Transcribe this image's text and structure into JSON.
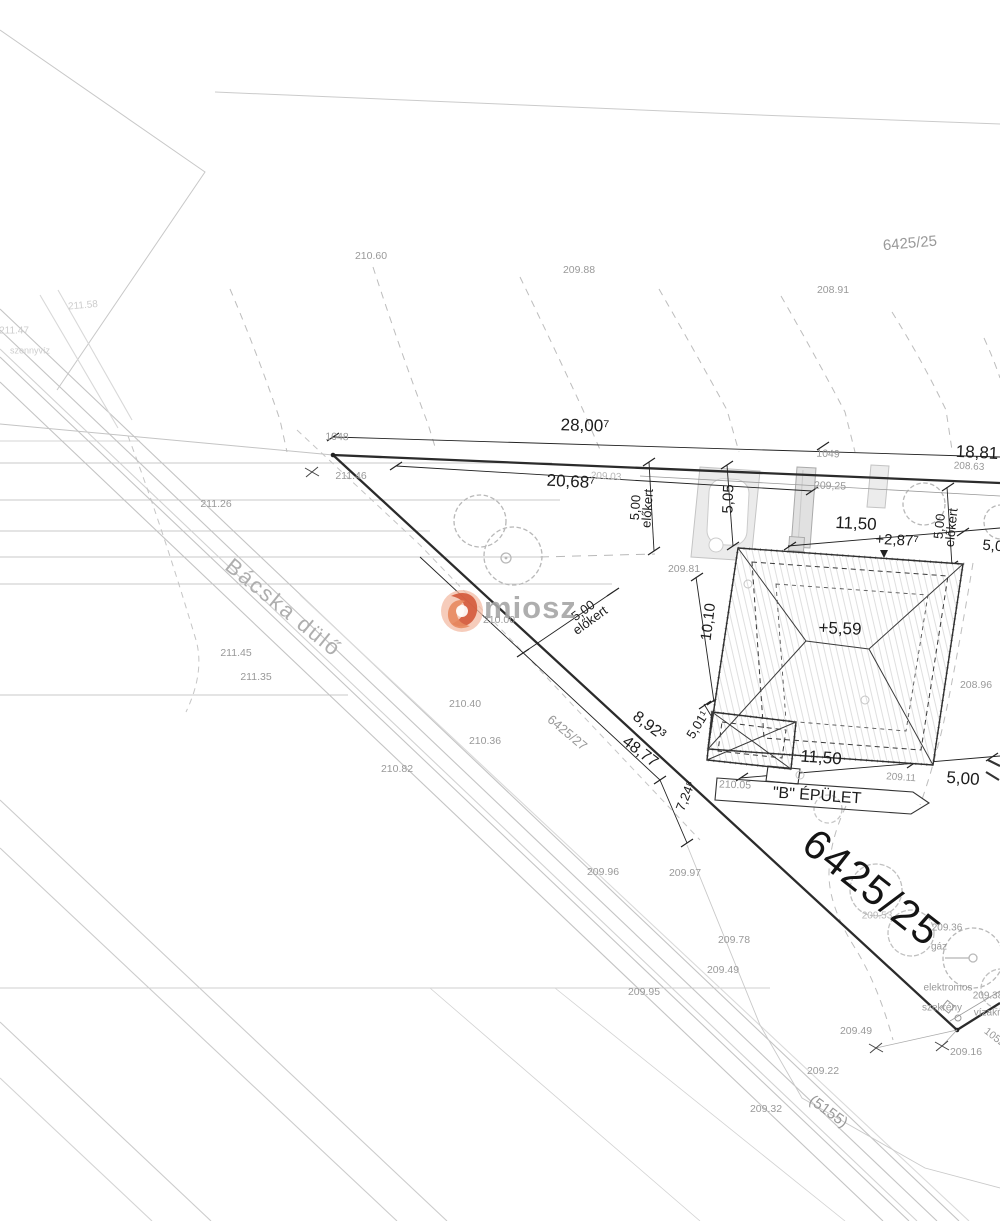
{
  "plan": {
    "type": "helyszínrajz (site plan)",
    "main_parcel": "6425/25",
    "road_parcel": "(5155)",
    "adjacent_parcel": "6425/27",
    "street_name": "Bácska dülő",
    "building_label": "\"B\" ÉPÜLET",
    "survey_point_numbers": [
      "1048",
      "1049",
      "1052"
    ]
  },
  "watermark": {
    "text": "miosz",
    "logo": "miosz-swirl-icon",
    "accent_color": "#cc4b2e"
  },
  "colors": {
    "boundary": "#2b2b2b",
    "dimension_text": "#1c1c1c",
    "elevation_text": "#999999",
    "contour": "#bdbdbd",
    "road": "#c4c4c4",
    "paving_fill": "#ebebeb"
  },
  "labels": [
    {
      "id": "parcel-6425-25-top",
      "text": "6425/25",
      "x": 910,
      "y": 244,
      "rot": -5,
      "fs": 15,
      "kind": "elev"
    },
    {
      "id": "spot-210-60",
      "text": "210.60",
      "x": 371,
      "y": 257,
      "rot": 0,
      "fs": 10.5,
      "kind": "elev"
    },
    {
      "id": "spot-209-88",
      "text": "209.88",
      "x": 579,
      "y": 271,
      "rot": 0,
      "fs": 10.5,
      "kind": "elev"
    },
    {
      "id": "spot-208-91",
      "text": "208.91",
      "x": 833,
      "y": 291,
      "rot": 0,
      "fs": 10.5,
      "kind": "elev"
    },
    {
      "id": "spot-211-58",
      "text": "211.58",
      "x": 83,
      "y": 306,
      "rot": -5,
      "fs": 10,
      "kind": "faint"
    },
    {
      "id": "spot-211-47",
      "text": "211.47",
      "x": 14,
      "y": 331,
      "rot": 0,
      "fs": 10,
      "kind": "faint"
    },
    {
      "id": "note-szennyviz",
      "text": "szennyvíz",
      "x": 30,
      "y": 351,
      "rot": 0,
      "fs": 9,
      "kind": "faint"
    },
    {
      "id": "dim-28-00",
      "text": "28,00⁷",
      "x": 585,
      "y": 426,
      "rot": 1.5,
      "fs": 17,
      "kind": "dim"
    },
    {
      "id": "pt-1048",
      "text": "1048",
      "x": 337,
      "y": 438,
      "rot": 1,
      "fs": 10.5,
      "kind": "elev"
    },
    {
      "id": "dim-18-81",
      "text": "18,81",
      "x": 977,
      "y": 453,
      "rot": 3,
      "fs": 17,
      "kind": "dim"
    },
    {
      "id": "spot-208-63",
      "text": "208.63",
      "x": 969,
      "y": 467,
      "rot": 3,
      "fs": 10,
      "kind": "elev"
    },
    {
      "id": "pt-1049",
      "text": "1049",
      "x": 828,
      "y": 455,
      "rot": 2,
      "fs": 10.5,
      "kind": "elev"
    },
    {
      "id": "spot-211-46",
      "text": "211.46",
      "x": 351,
      "y": 477,
      "rot": 0,
      "fs": 10.5,
      "kind": "elev"
    },
    {
      "id": "dim-20-68",
      "text": "20,68⁷",
      "x": 571,
      "y": 482,
      "rot": 3,
      "fs": 17,
      "kind": "dim"
    },
    {
      "id": "spot-209-03",
      "text": "209.03",
      "x": 606,
      "y": 477,
      "rot": 3,
      "fs": 10,
      "kind": "faint2"
    },
    {
      "id": "spot-209-25",
      "text": "209,25",
      "x": 830,
      "y": 487,
      "rot": 2,
      "fs": 10.5,
      "kind": "elev"
    },
    {
      "id": "spot-211-26",
      "text": "211.26",
      "x": 216,
      "y": 505,
      "rot": 0,
      "fs": 10.5,
      "kind": "elev"
    },
    {
      "id": "dim-5-05",
      "text": "5,05",
      "x": 729,
      "y": 499,
      "rot": -88,
      "fs": 15,
      "kind": "dim"
    },
    {
      "id": "dim-11-50-top",
      "text": "11,50",
      "x": 856,
      "y": 524,
      "rot": 3,
      "fs": 17,
      "kind": "dim"
    },
    {
      "id": "dim-plus-2-87",
      "text": "+2,87⁷",
      "x": 897,
      "y": 541,
      "rot": 3,
      "fs": 15,
      "kind": "dim"
    },
    {
      "id": "dim-elokert-right",
      "text": "5,00\nelőkert",
      "x": 946,
      "y": 527,
      "rot": -84,
      "fs": 13,
      "kind": "dim2"
    },
    {
      "id": "dim-5-05-edge",
      "text": "5,05",
      "x": 997,
      "y": 547,
      "rot": 5,
      "fs": 15,
      "kind": "dim"
    },
    {
      "id": "spot-209-81",
      "text": "209.81",
      "x": 684,
      "y": 570,
      "rot": 0,
      "fs": 10.5,
      "kind": "elev"
    },
    {
      "id": "street-bacska-dulo",
      "text": "Bácska dülő",
      "x": 283,
      "y": 608,
      "rot": 39,
      "fs": 22,
      "kind": "street"
    },
    {
      "id": "spot-210-00",
      "text": "210.00",
      "x": 499,
      "y": 621,
      "rot": 0,
      "fs": 10.5,
      "kind": "elev"
    },
    {
      "id": "dim-elokert-left",
      "text": "5,00\nelőkert",
      "x": 587,
      "y": 616,
      "rot": -36,
      "fs": 13,
      "kind": "dim2"
    },
    {
      "id": "dim-elokert-mid",
      "text": "5,00\nelőkert",
      "x": 642,
      "y": 508,
      "rot": -86,
      "fs": 13,
      "kind": "dim2"
    },
    {
      "id": "dim-10-10",
      "text": "10,10",
      "x": 709,
      "y": 622,
      "rot": -83,
      "fs": 15,
      "kind": "dim"
    },
    {
      "id": "dim-plus-5-59",
      "text": "+5,59",
      "x": 840,
      "y": 629,
      "rot": 2,
      "fs": 17,
      "kind": "dim"
    },
    {
      "id": "spot-211-45",
      "text": "211.45",
      "x": 236,
      "y": 654,
      "rot": 0,
      "fs": 10.5,
      "kind": "elev"
    },
    {
      "id": "spot-211-35",
      "text": "211.35",
      "x": 256,
      "y": 678,
      "rot": 0,
      "fs": 10.5,
      "kind": "elev"
    },
    {
      "id": "spot-208-96",
      "text": "208.96",
      "x": 976,
      "y": 686,
      "rot": 0,
      "fs": 10.5,
      "kind": "elev"
    },
    {
      "id": "spot-210-40",
      "text": "210.40",
      "x": 465,
      "y": 705,
      "rot": 0,
      "fs": 10.5,
      "kind": "elev"
    },
    {
      "id": "dim-5-01",
      "text": "5,01¹",
      "x": 698,
      "y": 725,
      "rot": -58,
      "fs": 13,
      "kind": "dim"
    },
    {
      "id": "parcel-6425-27",
      "text": "6425/27",
      "x": 567,
      "y": 733,
      "rot": 40,
      "fs": 13,
      "kind": "elev"
    },
    {
      "id": "dim-8-92",
      "text": "8,92³",
      "x": 649,
      "y": 726,
      "rot": 37,
      "fs": 16,
      "kind": "dim"
    },
    {
      "id": "spot-210-36",
      "text": "210.36",
      "x": 485,
      "y": 742,
      "rot": 0,
      "fs": 10.5,
      "kind": "elev"
    },
    {
      "id": "dim-48-77",
      "text": "48,77",
      "x": 640,
      "y": 752,
      "rot": 37,
      "fs": 16,
      "kind": "dim"
    },
    {
      "id": "dim-7-24",
      "text": "7,24⁸",
      "x": 686,
      "y": 796,
      "rot": -68,
      "fs": 13,
      "kind": "dim"
    },
    {
      "id": "spot-210-82",
      "text": "210.82",
      "x": 397,
      "y": 770,
      "rot": 0,
      "fs": 10.5,
      "kind": "elev"
    },
    {
      "id": "dim-11-50-bottom",
      "text": "11,50",
      "x": 821,
      "y": 758,
      "rot": 4,
      "fs": 17,
      "kind": "dim"
    },
    {
      "id": "spot-209-11",
      "text": "209.11",
      "x": 901,
      "y": 778,
      "rot": 4,
      "fs": 10,
      "kind": "elev"
    },
    {
      "id": "dim-5-00-bottom",
      "text": "5,00",
      "x": 963,
      "y": 779,
      "rot": 4,
      "fs": 17,
      "kind": "dim"
    },
    {
      "id": "spot-210-05",
      "text": "210.05",
      "x": 735,
      "y": 786,
      "rot": 2,
      "fs": 10.5,
      "kind": "elev"
    },
    {
      "id": "label-b-epulet",
      "text": "\"B\" ÉPÜLET",
      "x": 817,
      "y": 796,
      "rot": 4,
      "fs": 16,
      "kind": "dim"
    },
    {
      "id": "parcel-6425-25-big",
      "text": "6425/25",
      "x": 872,
      "y": 888,
      "rot": 38,
      "fs": 41,
      "kind": "big"
    },
    {
      "id": "spot-209-96",
      "text": "209.96",
      "x": 603,
      "y": 873,
      "rot": 0,
      "fs": 10.5,
      "kind": "elev"
    },
    {
      "id": "spot-209-97",
      "text": "209.97",
      "x": 685,
      "y": 874,
      "rot": 0,
      "fs": 10.5,
      "kind": "elev"
    },
    {
      "id": "spot-209-53",
      "text": "209.53",
      "x": 877,
      "y": 916,
      "rot": 0,
      "fs": 10,
      "kind": "faint2"
    },
    {
      "id": "spot-209-36",
      "text": "209.36",
      "x": 947,
      "y": 928,
      "rot": 0,
      "fs": 10,
      "kind": "elev"
    },
    {
      "id": "util-gaz",
      "text": "gáz",
      "x": 939,
      "y": 947,
      "rot": 0,
      "fs": 10,
      "kind": "elev"
    },
    {
      "id": "spot-209-78",
      "text": "209.78",
      "x": 734,
      "y": 941,
      "rot": 0,
      "fs": 10.5,
      "kind": "elev"
    },
    {
      "id": "spot-209-49-a",
      "text": "209.49",
      "x": 723,
      "y": 971,
      "rot": 0,
      "fs": 10.5,
      "kind": "elev"
    },
    {
      "id": "util-elektromos",
      "text": "elektromos",
      "x": 948,
      "y": 988,
      "rot": 0,
      "fs": 10,
      "kind": "elev"
    },
    {
      "id": "spot-209-38",
      "text": "209.38",
      "x": 988,
      "y": 996,
      "rot": 0,
      "fs": 10,
      "kind": "elev"
    },
    {
      "id": "util-szekreny",
      "text": "szekrény",
      "x": 942,
      "y": 1008,
      "rot": 0,
      "fs": 10,
      "kind": "elev"
    },
    {
      "id": "util-vizakna",
      "text": "vízakna",
      "x": 991,
      "y": 1013,
      "rot": 0,
      "fs": 10,
      "kind": "elev"
    },
    {
      "id": "spot-209-95",
      "text": "209.95",
      "x": 644,
      "y": 993,
      "rot": 0,
      "fs": 10.5,
      "kind": "elev"
    },
    {
      "id": "spot-209-49-b",
      "text": "209.49",
      "x": 856,
      "y": 1032,
      "rot": 0,
      "fs": 10.5,
      "kind": "elev"
    },
    {
      "id": "pt-1052",
      "text": "1052",
      "x": 994,
      "y": 1038,
      "rot": 38,
      "fs": 10.5,
      "kind": "elev"
    },
    {
      "id": "spot-209-16",
      "text": "209.16",
      "x": 966,
      "y": 1053,
      "rot": 0,
      "fs": 10.5,
      "kind": "elev"
    },
    {
      "id": "spot-209-22",
      "text": "209.22",
      "x": 823,
      "y": 1072,
      "rot": 0,
      "fs": 10.5,
      "kind": "elev"
    },
    {
      "id": "road-5155",
      "text": "(5155)",
      "x": 828,
      "y": 1112,
      "rot": 36,
      "fs": 15,
      "kind": "elev"
    },
    {
      "id": "spot-209-32",
      "text": "209.32",
      "x": 766,
      "y": 1110,
      "rot": 0,
      "fs": 10.5,
      "kind": "elev"
    }
  ]
}
